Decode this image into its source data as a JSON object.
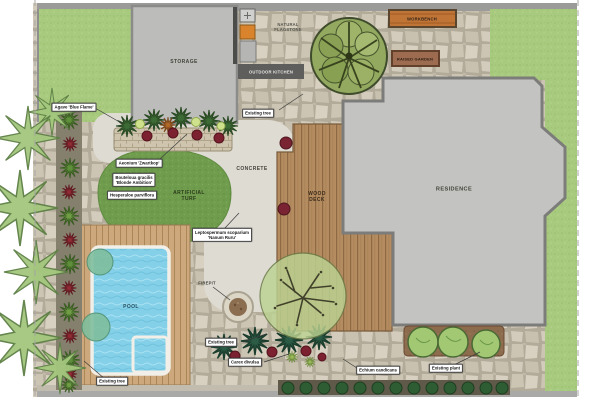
{
  "areas": {
    "storage": "STORAGE",
    "natural_flagstone": [
      "NATURAL",
      "FLAGSTONE"
    ],
    "outdoor_kitchen": "OUTDOOR KITCHEN",
    "workbench": "WORKBENCH",
    "raised_garden": "RAISED GARDEN",
    "residence": "RESIDENCE",
    "concrete": "CONCRETE",
    "wood_deck": [
      "WOOD",
      "DECK"
    ],
    "artificial_turf": [
      "ARTIFICIAL",
      "TURF"
    ],
    "pool": "POOL",
    "firepit": "FIREPIT"
  },
  "plants": {
    "agave": "Agave 'Blue Flame'",
    "aeonium": "Aeonium 'Zwartkop'",
    "bouteloua": [
      "Bouteloua gracilis",
      "'Blonde Ambition'"
    ],
    "hesperaloe": "Hesperaloe parviflora",
    "leptospermum": [
      "Leptospermum scoparium",
      "'Nanum Ruru'"
    ],
    "existing_tree": "Existing tree",
    "carex": "Carex divulsa",
    "echium": "Echium candicans",
    "existing_plant": "Existing plant"
  },
  "colors": {
    "lawn": "#a8ca7e",
    "artificial_turf": "#6f9c4d",
    "flagstone_joint": "#b3ab99",
    "concrete": "#dedbd3",
    "wood_deck": "#b48c60",
    "pool_deck": "#cca87c",
    "pool_water": "#84d0e8",
    "residence": "#c3c3c1",
    "storage": "#bcbcba",
    "kitchen_bar": "#5e5e5c",
    "workbench": "#c07536",
    "raised_garden": "#9c6b50",
    "soil": "#8d6c4e",
    "wall": "#9b9b99"
  }
}
